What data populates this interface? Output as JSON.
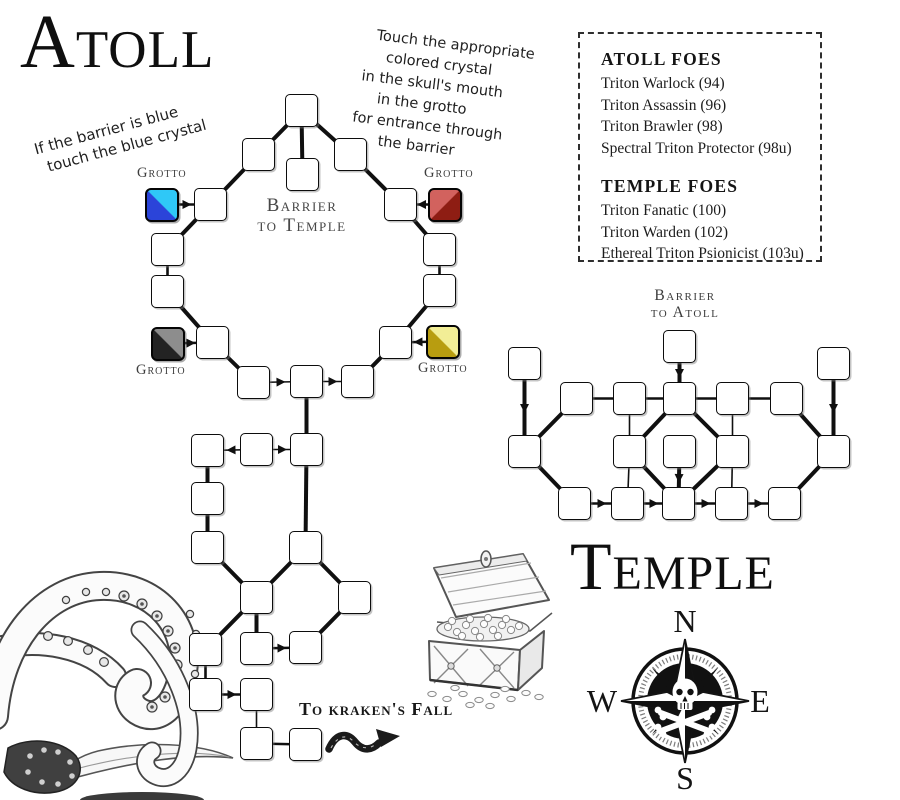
{
  "titles": {
    "atoll": "Atoll",
    "temple": "Temple"
  },
  "notes": {
    "blue_note": [
      "If the barrier is blue",
      "touch the blue crystal"
    ],
    "crystal_note": [
      "Touch the appropriate",
      "colored crystal",
      "in the skull's mouth",
      "in the grotto",
      "for entrance through",
      "the barrier"
    ]
  },
  "foes_panel": {
    "sections": [
      {
        "heading": "Atoll Foes",
        "entries": [
          "Triton Warlock (94)",
          "Triton Assassin (96)",
          "Triton Brawler (98)",
          "Spectral Triton Protector (98u)"
        ]
      },
      {
        "heading": "Temple Foes",
        "entries": [
          "Triton Fanatic (100)",
          "Triton Warden (102)",
          "Ethereal Triton Psionicist (103u)"
        ]
      }
    ]
  },
  "labels": {
    "barrier_to_temple_1": "Barrier",
    "barrier_to_temple_2": "to Temple",
    "barrier_to_atoll_1": "Barrier",
    "barrier_to_atoll_2": "to Atoll",
    "grotto": "Grotto",
    "to_krakens_fall": "To kraken's Fall"
  },
  "compass": {
    "n": "N",
    "e": "E",
    "s": "S",
    "w": "W"
  },
  "map_data": {
    "room_size": 33,
    "line_color": "#101010",
    "rooms": [
      {
        "id": "T",
        "x": 285,
        "y": 94
      },
      {
        "id": "BR",
        "x": 286,
        "y": 158
      },
      {
        "id": "UL",
        "x": 242,
        "y": 138
      },
      {
        "id": "UR",
        "x": 334,
        "y": 138
      },
      {
        "id": "LU",
        "x": 194,
        "y": 188
      },
      {
        "id": "RU",
        "x": 384,
        "y": 188
      },
      {
        "id": "L1",
        "x": 151,
        "y": 233
      },
      {
        "id": "L2",
        "x": 151,
        "y": 275
      },
      {
        "id": "LB",
        "x": 196,
        "y": 326
      },
      {
        "id": "RB",
        "x": 379,
        "y": 326
      },
      {
        "id": "R1",
        "x": 423,
        "y": 233
      },
      {
        "id": "R2",
        "x": 423,
        "y": 274
      },
      {
        "id": "BL",
        "x": 237,
        "y": 366
      },
      {
        "id": "BC",
        "x": 290,
        "y": 365
      },
      {
        "id": "BT",
        "x": 341,
        "y": 365
      },
      {
        "id": "C1",
        "x": 191,
        "y": 434
      },
      {
        "id": "C2",
        "x": 240,
        "y": 433
      },
      {
        "id": "C3",
        "x": 290,
        "y": 433
      },
      {
        "id": "C4",
        "x": 191,
        "y": 482
      },
      {
        "id": "C5",
        "x": 191,
        "y": 531
      },
      {
        "id": "C6",
        "x": 289,
        "y": 531
      },
      {
        "id": "C7",
        "x": 240,
        "y": 581
      },
      {
        "id": "C8",
        "x": 338,
        "y": 581
      },
      {
        "id": "C9",
        "x": 189,
        "y": 633
      },
      {
        "id": "C10",
        "x": 240,
        "y": 632
      },
      {
        "id": "C11",
        "x": 289,
        "y": 631
      },
      {
        "id": "C12",
        "x": 189,
        "y": 678
      },
      {
        "id": "C13",
        "x": 240,
        "y": 678
      },
      {
        "id": "C14",
        "x": 240,
        "y": 727
      },
      {
        "id": "C15",
        "x": 289,
        "y": 728
      },
      {
        "id": "TE",
        "x": 663,
        "y": 330
      },
      {
        "id": "TL",
        "x": 508,
        "y": 347
      },
      {
        "id": "TR",
        "x": 817,
        "y": 347
      },
      {
        "id": "A1",
        "x": 560,
        "y": 382
      },
      {
        "id": "A2",
        "x": 613,
        "y": 382
      },
      {
        "id": "A3",
        "x": 663,
        "y": 382
      },
      {
        "id": "A4",
        "x": 716,
        "y": 382
      },
      {
        "id": "A5",
        "x": 770,
        "y": 382
      },
      {
        "id": "M0",
        "x": 508,
        "y": 435
      },
      {
        "id": "M1",
        "x": 613,
        "y": 435
      },
      {
        "id": "MC",
        "x": 663,
        "y": 435
      },
      {
        "id": "M2",
        "x": 716,
        "y": 435
      },
      {
        "id": "M3",
        "x": 817,
        "y": 435
      },
      {
        "id": "B1",
        "x": 558,
        "y": 487
      },
      {
        "id": "B2",
        "x": 611,
        "y": 487
      },
      {
        "id": "B3",
        "x": 662,
        "y": 487
      },
      {
        "id": "B4",
        "x": 715,
        "y": 487
      },
      {
        "id": "B5",
        "x": 768,
        "y": 487
      }
    ],
    "crystals": [
      {
        "id": "blue",
        "x": 145,
        "y": 188,
        "dir": "bl",
        "light": "#2fc8f7",
        "dark": "#2b44d9"
      },
      {
        "id": "red",
        "x": 428,
        "y": 188,
        "dir": "br",
        "light": "#d2625e",
        "dark": "#8e1d13"
      },
      {
        "id": "black",
        "x": 151,
        "y": 327,
        "dir": "bl",
        "light": "#8d8d8d",
        "dark": "#232323"
      },
      {
        "id": "yellow",
        "x": 426,
        "y": 325,
        "dir": "bl",
        "light": "#f2ee96",
        "dark": "#b89d10"
      }
    ],
    "edges": [
      [
        "T",
        "UL",
        "t",
        0
      ],
      [
        "T",
        "UR",
        "t",
        0
      ],
      [
        "T",
        "BR",
        "t",
        0
      ],
      [
        "UL",
        "LU",
        "t",
        0
      ],
      [
        "blue",
        "LU",
        "m",
        1
      ],
      [
        "LU",
        "L1",
        "t",
        0
      ],
      [
        "L1",
        "L2",
        "m",
        0
      ],
      [
        "L2",
        "LB",
        "t",
        0
      ],
      [
        "black",
        "LB",
        "m",
        1
      ],
      [
        "LB",
        "BL",
        "t",
        0
      ],
      [
        "BL",
        "BC",
        "n",
        1
      ],
      [
        "BC",
        "BT",
        "n",
        1
      ],
      [
        "BT",
        "RB",
        "t",
        0
      ],
      [
        "yellow",
        "RB",
        "m",
        1
      ],
      [
        "RB",
        "R2",
        "t",
        0
      ],
      [
        "R2",
        "R1",
        "m",
        0
      ],
      [
        "R1",
        "RU",
        "t",
        0
      ],
      [
        "red",
        "RU",
        "m",
        1
      ],
      [
        "RU",
        "UR",
        "t",
        0
      ],
      [
        "BC",
        "C3",
        "t",
        0
      ],
      [
        "C2",
        "C1",
        "n",
        1
      ],
      [
        "C2",
        "C3",
        "n",
        1
      ],
      [
        "C1",
        "C4",
        "t",
        0
      ],
      [
        "C4",
        "C5",
        "t",
        0
      ],
      [
        "C3",
        "C6",
        "t",
        0
      ],
      [
        "C5",
        "C7",
        "t",
        0
      ],
      [
        "C6",
        "C7",
        "t",
        0
      ],
      [
        "C6",
        "C8",
        "t",
        0
      ],
      [
        "C7",
        "C9",
        "t",
        0
      ],
      [
        "C7",
        "C10",
        "t",
        0
      ],
      [
        "C8",
        "C11",
        "t",
        0
      ],
      [
        "C10",
        "C11",
        "m",
        1
      ],
      [
        "C9",
        "C12",
        "m",
        0
      ],
      [
        "C12",
        "C13",
        "m",
        1
      ],
      [
        "C13",
        "C14",
        "n",
        0
      ],
      [
        "C14",
        "C15",
        "m",
        0
      ],
      [
        "TE",
        "A3",
        "t",
        1
      ],
      [
        "A1",
        "A2",
        "m",
        0
      ],
      [
        "A2",
        "A3",
        "m",
        0
      ],
      [
        "A3",
        "A4",
        "m",
        0
      ],
      [
        "A4",
        "A5",
        "m",
        0
      ],
      [
        "TL",
        "M0",
        "t",
        1
      ],
      [
        "A1",
        "M0",
        "t",
        0
      ],
      [
        "TR",
        "M3",
        "t",
        1
      ],
      [
        "A5",
        "M3",
        "t",
        0
      ],
      [
        "A2",
        "M1",
        "n",
        0
      ],
      [
        "A4",
        "M2",
        "n",
        0
      ],
      [
        "A3",
        "M1",
        "t",
        0
      ],
      [
        "A3",
        "M2",
        "t",
        0
      ],
      [
        "M1",
        "B3",
        "t",
        0
      ],
      [
        "M2",
        "B3",
        "t",
        0
      ],
      [
        "MC",
        "B3",
        "t",
        1
      ],
      [
        "M0",
        "B1",
        "t",
        0
      ],
      [
        "M3",
        "B5",
        "t",
        0
      ],
      [
        "M1",
        "B2",
        "n",
        0
      ],
      [
        "M2",
        "B4",
        "n",
        0
      ],
      [
        "B1",
        "B2",
        "m",
        1
      ],
      [
        "B2",
        "B3",
        "m",
        1
      ],
      [
        "B3",
        "B4",
        "m",
        1
      ],
      [
        "B4",
        "B5",
        "m",
        1
      ]
    ]
  }
}
